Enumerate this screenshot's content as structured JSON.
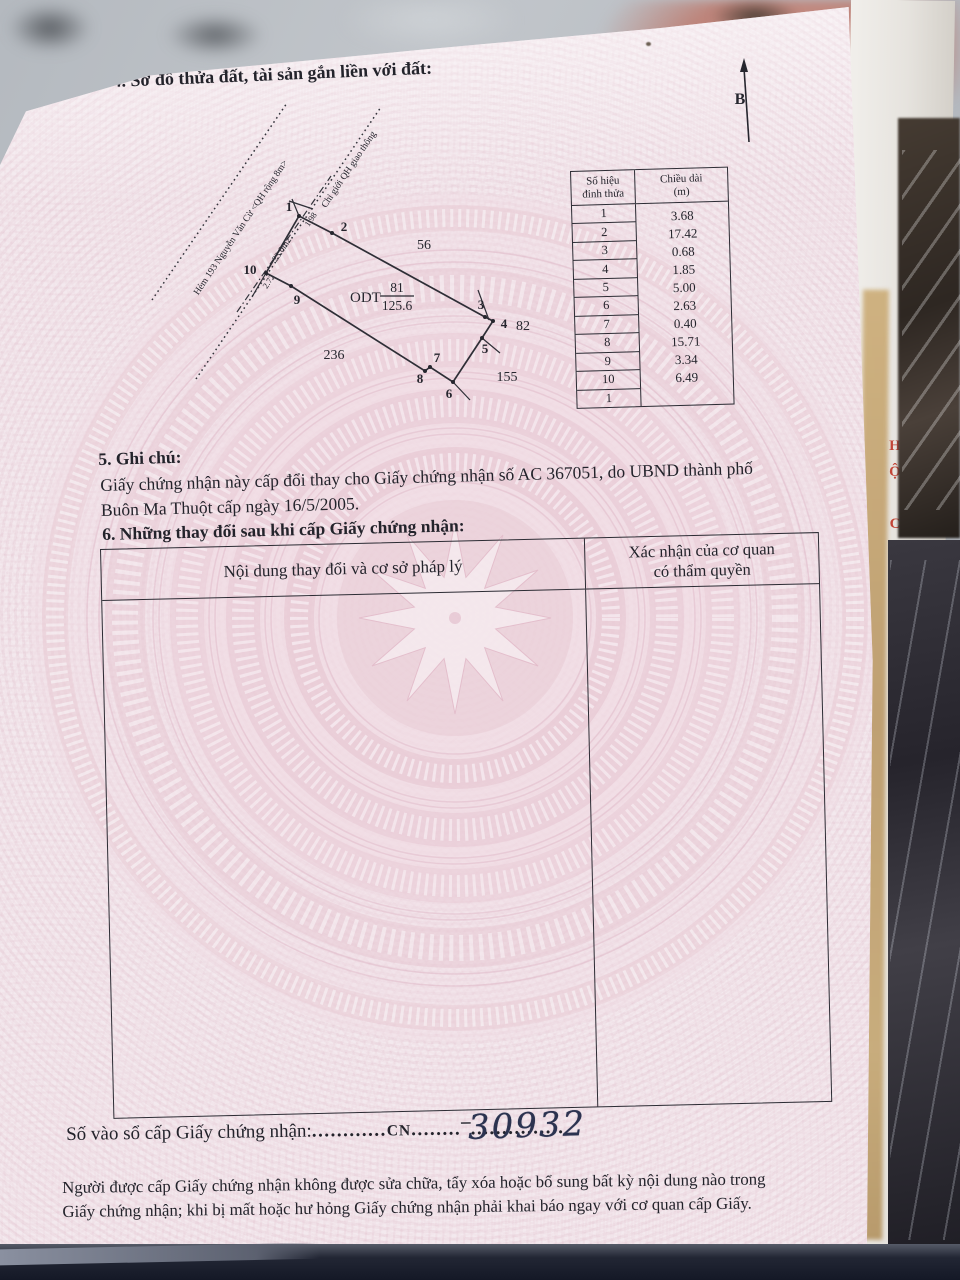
{
  "page": {
    "section4_title": "4. Sơ đồ thửa đất, tài sản gắn liền với đất:",
    "north_label": "B"
  },
  "vertex_table": {
    "col1_header_line1": "Số hiệu",
    "col1_header_line2": "đỉnh thửa",
    "col2_header_line1": "Chiều dài",
    "col2_header_line2": "(m)",
    "rows": [
      {
        "v": "1",
        "len": "3.68"
      },
      {
        "v": "2",
        "len": "17.42"
      },
      {
        "v": "3",
        "len": "0.68"
      },
      {
        "v": "4",
        "len": "1.85"
      },
      {
        "v": "5",
        "len": "5.00"
      },
      {
        "v": "6",
        "len": "2.63"
      },
      {
        "v": "7",
        "len": "0.40"
      },
      {
        "v": "8",
        "len": "15.71"
      },
      {
        "v": "9",
        "len": "3.34"
      },
      {
        "v": "10",
        "len": "6.49"
      },
      {
        "v": "1",
        "len": ""
      }
    ]
  },
  "diagram": {
    "road_label_1": "Hẻm 193 Nguyễn Văn Cừ <QH rộng 8m>",
    "road_label_2": "Chỉ giới QH giao thông",
    "strip_area": "23.0m2",
    "dim_a": "1.98",
    "dim_b": "2.72",
    "land_use_code": "ODT",
    "parcel_number": "81",
    "parcel_area": "125.6",
    "adjacent_56": "56",
    "adjacent_82": "82",
    "adjacent_155": "155",
    "adjacent_236": "236",
    "vertices": [
      "1",
      "2",
      "3",
      "4",
      "5",
      "6",
      "7",
      "8",
      "9",
      "10"
    ]
  },
  "section5": {
    "title": "5. Ghi chú:",
    "line1": "Giấy chứng nhận này cấp đổi thay cho Giấy chứng nhận số AC 367051, do UBND thành phố",
    "line2": "Buôn Ma Thuột cấp ngày 16/5/2005."
  },
  "section6": {
    "title": "6. Những thay đổi sau khi cấp Giấy chứng nhận:",
    "col1_header": "Nội dung thay đổi và cơ sở pháp lý",
    "col2_header_line1": "Xác nhận của cơ quan",
    "col2_header_line2": "có thẩm quyền"
  },
  "serial": {
    "label": "Số vào sổ cấp Giấy chứng nhận:",
    "dots1": "............",
    "prefix": "CN",
    "dots2": "........",
    "dash": "–",
    "dots3": "......",
    "number": "30932",
    "dots4": "........."
  },
  "footer": {
    "note_line1": "Người được cấp Giấy chứng nhận không được sửa chữa, tẩy xóa hoặc bổ sung bất kỳ nội dung nào trong",
    "note_line2": "Giấy chứng nhận; khi bị mất hoặc hư hỏng Giấy chứng nhận phải khai báo ngay với cơ quan cấp Giấy."
  },
  "background": {
    "side_red_text": "HỘ CƯ M T"
  }
}
